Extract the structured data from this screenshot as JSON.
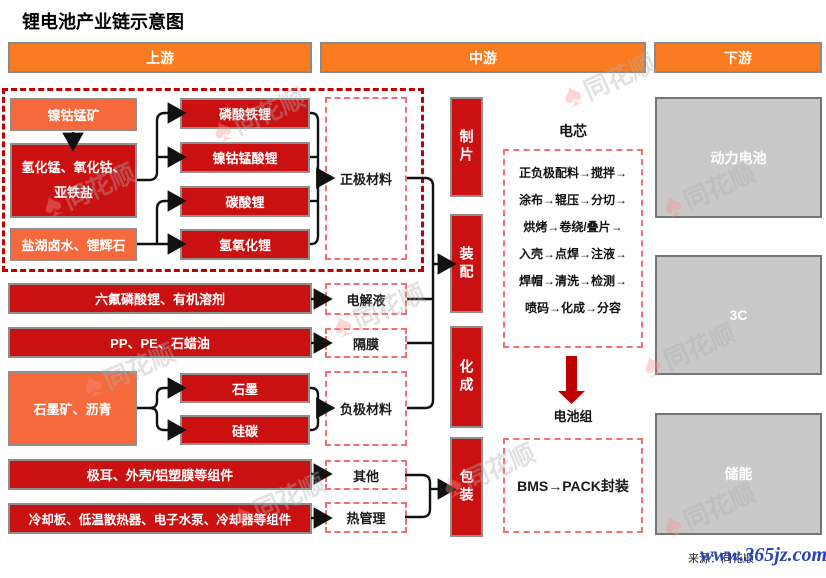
{
  "title": "锂电池产业链示意图",
  "headers": {
    "upstream": "上游",
    "midstream": "中游",
    "downstream": "下游"
  },
  "upstream": {
    "nickel_ore": "镍钴锰矿",
    "precursors": "氢化锰、氧化钴、亚铁盐",
    "lithium_source": "盐湖卤水、锂辉石",
    "cathode_products": [
      "磷酸铁锂",
      "镍钴锰酸锂",
      "碳酸锂",
      "氢氧化锂"
    ],
    "electrolyte_materials": "六氟磷酸锂、有机溶剂",
    "separator_materials": "PP、PE、石蜡油",
    "anode_source": "石墨矿、沥青",
    "anode_products": [
      "石墨",
      "硅碳"
    ],
    "other_components": "极耳、外壳/铝塑膜等组件",
    "thermal_components": "冷却板、低温散热器、电子水泵、冷却器等组件"
  },
  "materials": {
    "cathode": "正极材料",
    "electrolyte": "电解液",
    "separator": "隔膜",
    "anode": "负极材料",
    "other": "其他",
    "thermal": "热管理"
  },
  "process_steps": [
    "制片",
    "装配",
    "化成",
    "包装"
  ],
  "cell": {
    "title": "电芯",
    "flow_lines": [
      "正负极配料→搅拌→",
      "涂布→辊压→分切→",
      "烘烤→卷绕/叠片→",
      "入壳→点焊→注液→",
      "焊帽→清洗→检测→",
      "喷码→化成→分容"
    ]
  },
  "pack": {
    "title": "电池组",
    "flow": "BMS→PACK封装"
  },
  "downstream": {
    "applications": [
      "动力电池",
      "3C",
      "储能"
    ]
  },
  "footer": {
    "source": "来源：同花顺",
    "watermark_site": "www.365jz.com"
  },
  "watermark": {
    "logo_glyph": "♠",
    "text": "同花顺"
  },
  "colors": {
    "header_orange": "#FB7B20",
    "box_red": "#CB1011",
    "box_orange": "#F5693D",
    "dashed_red": "#C00000",
    "light_dashed_red": "#F37070",
    "gray_box": "#C9C9C9",
    "arrow_black": "#111111",
    "big_arrow_red": "#C00000",
    "site_blue": "#2845B5"
  }
}
